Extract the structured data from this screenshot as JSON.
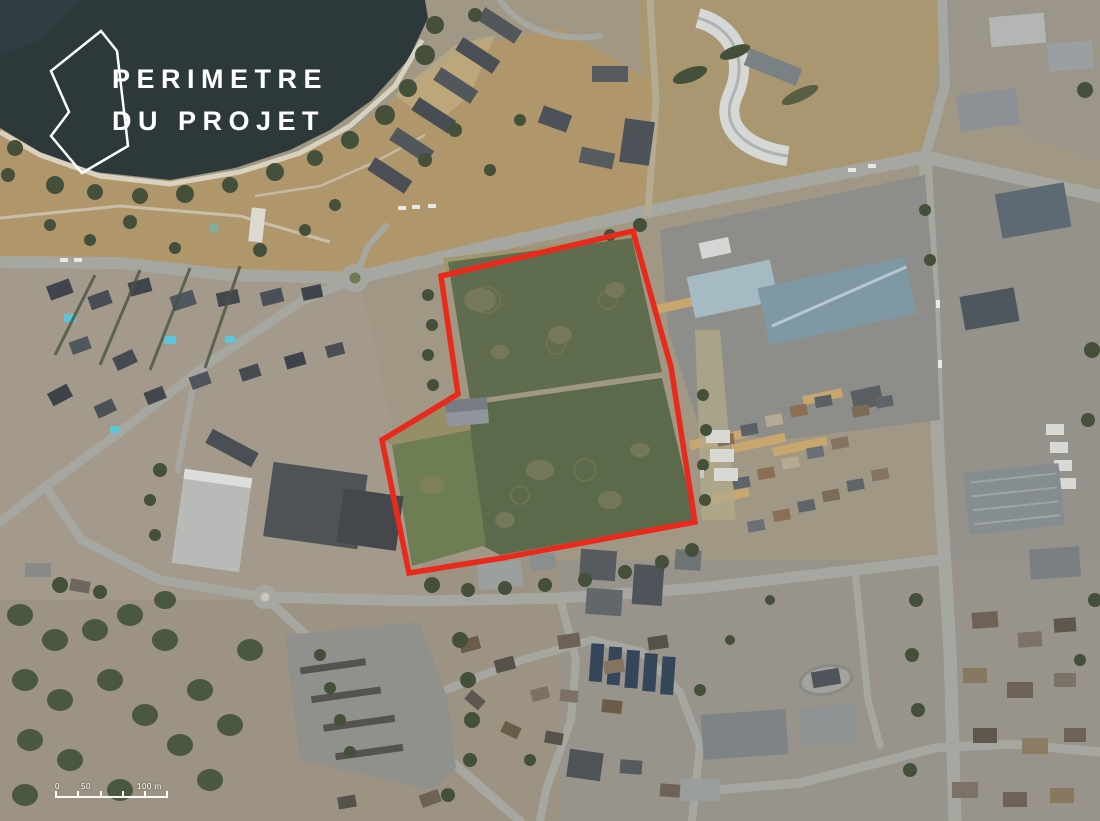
{
  "header": {
    "title_line1": "PERIMETRE",
    "title_line2": "DU PROJET",
    "text_color": "#ffffff",
    "icon_points": "57,7 7,47 25,88 7,112 38,149 84,122 73,27"
  },
  "map": {
    "kind": "aerial-photo-with-project-perimeter",
    "perimeter": {
      "points": "633,231 441,276 458,394 445,402 382,440 409,573 502,558 695,522 671,367",
      "color": "#e8291c"
    },
    "colors": {
      "lake": "#2d383b",
      "park_grass": "#b0976b",
      "field_green": "#5f6d4e",
      "field_green_light": "#6e7d53",
      "road": "#a7a7a2",
      "industrial_roof_blue": "#7e98a4"
    }
  },
  "scale_bar": {
    "labels": [
      "0",
      "50",
      "100 m"
    ]
  }
}
